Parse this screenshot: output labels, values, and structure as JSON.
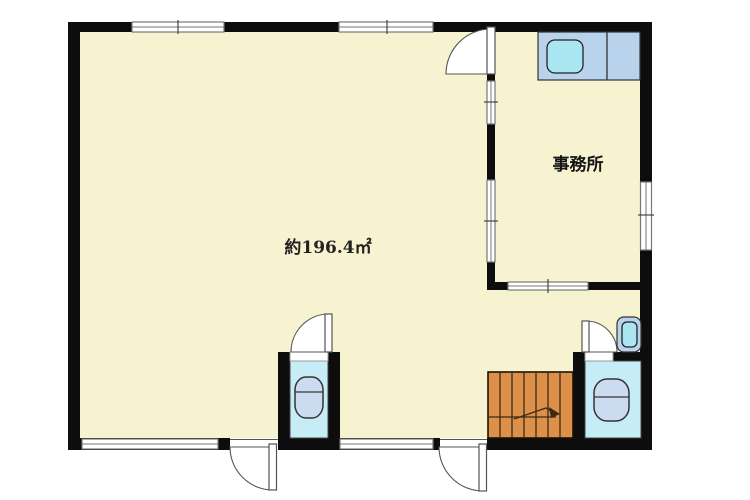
{
  "floor_plan": {
    "area_label": "約196.4㎡",
    "office_label": "事務所",
    "rooms": [
      {
        "name": "main-room",
        "label": "約196.4㎡"
      },
      {
        "name": "office",
        "label": "事務所"
      },
      {
        "name": "wc-center",
        "label": ""
      },
      {
        "name": "wc-right",
        "label": ""
      }
    ],
    "fixtures": [
      "kitchen-sink-counter",
      "toilet-center",
      "toilet-right",
      "hand-wash-basin",
      "staircase-with-up-arrow"
    ]
  },
  "colors": {
    "page_bg": "#ffffff",
    "floor": "#f7f3d0",
    "wall": "#0d0d0d",
    "wc_floor": "#c6ecf6",
    "counter": "#b9d3ec",
    "basin": "#a9e6f2",
    "fixture": "#ccdcf0",
    "stairs": "#dd9049",
    "outline": "#333333",
    "window_line": "#777777",
    "door_line": "#555555"
  }
}
